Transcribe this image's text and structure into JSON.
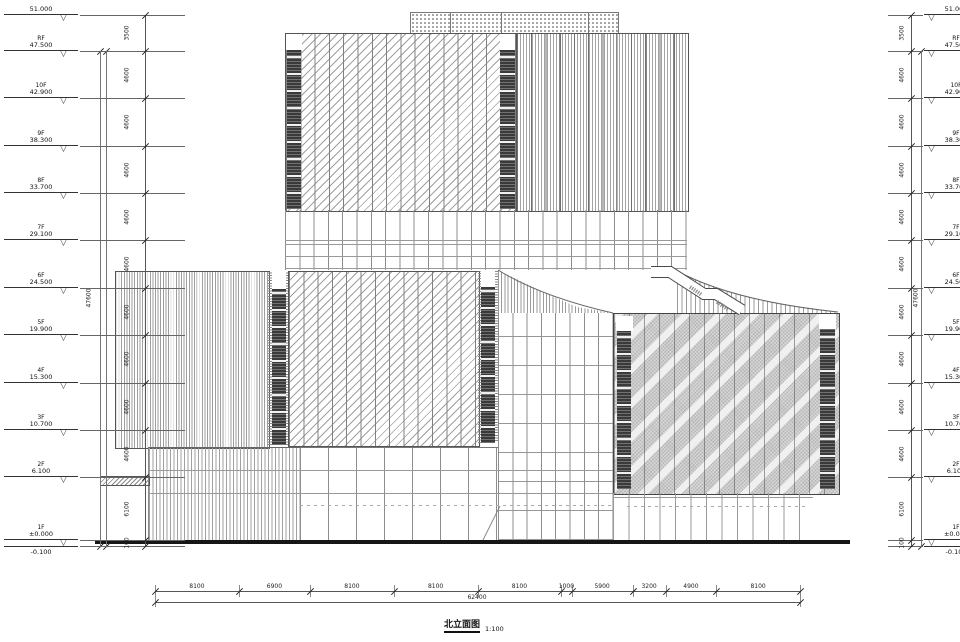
{
  "drawing": {
    "type": "architectural-elevation",
    "title": "北立面图",
    "scale": "1:100",
    "marker_glyph": "▽",
    "levels": [
      {
        "name": "",
        "value": "51.000"
      },
      {
        "name": "RF",
        "value": "47.500"
      },
      {
        "name": "10F",
        "value": "42.900"
      },
      {
        "name": "9F",
        "value": "38.300"
      },
      {
        "name": "8F",
        "value": "33.700"
      },
      {
        "name": "7F",
        "value": "29.100"
      },
      {
        "name": "6F",
        "value": "24.500"
      },
      {
        "name": "5F",
        "value": "19.900"
      },
      {
        "name": "4F",
        "value": "15.300"
      },
      {
        "name": "3F",
        "value": "10.700"
      },
      {
        "name": "2F",
        "value": "6.100"
      },
      {
        "name": "1F",
        "value": "±0.000"
      },
      {
        "name": "",
        "value": "-0.100"
      }
    ],
    "floor_dims": [
      "3500",
      "4600",
      "4600",
      "4600",
      "4600",
      "4600",
      "4600",
      "4600",
      "4600",
      "4600",
      "6100",
      "100"
    ],
    "overall_height": "47600",
    "bottom_dims": {
      "bays": [
        "8100",
        "6900",
        "8100",
        "8100",
        "8100",
        "1000",
        "5900",
        "3200",
        "4900",
        "8100"
      ],
      "overall": "62400"
    }
  }
}
